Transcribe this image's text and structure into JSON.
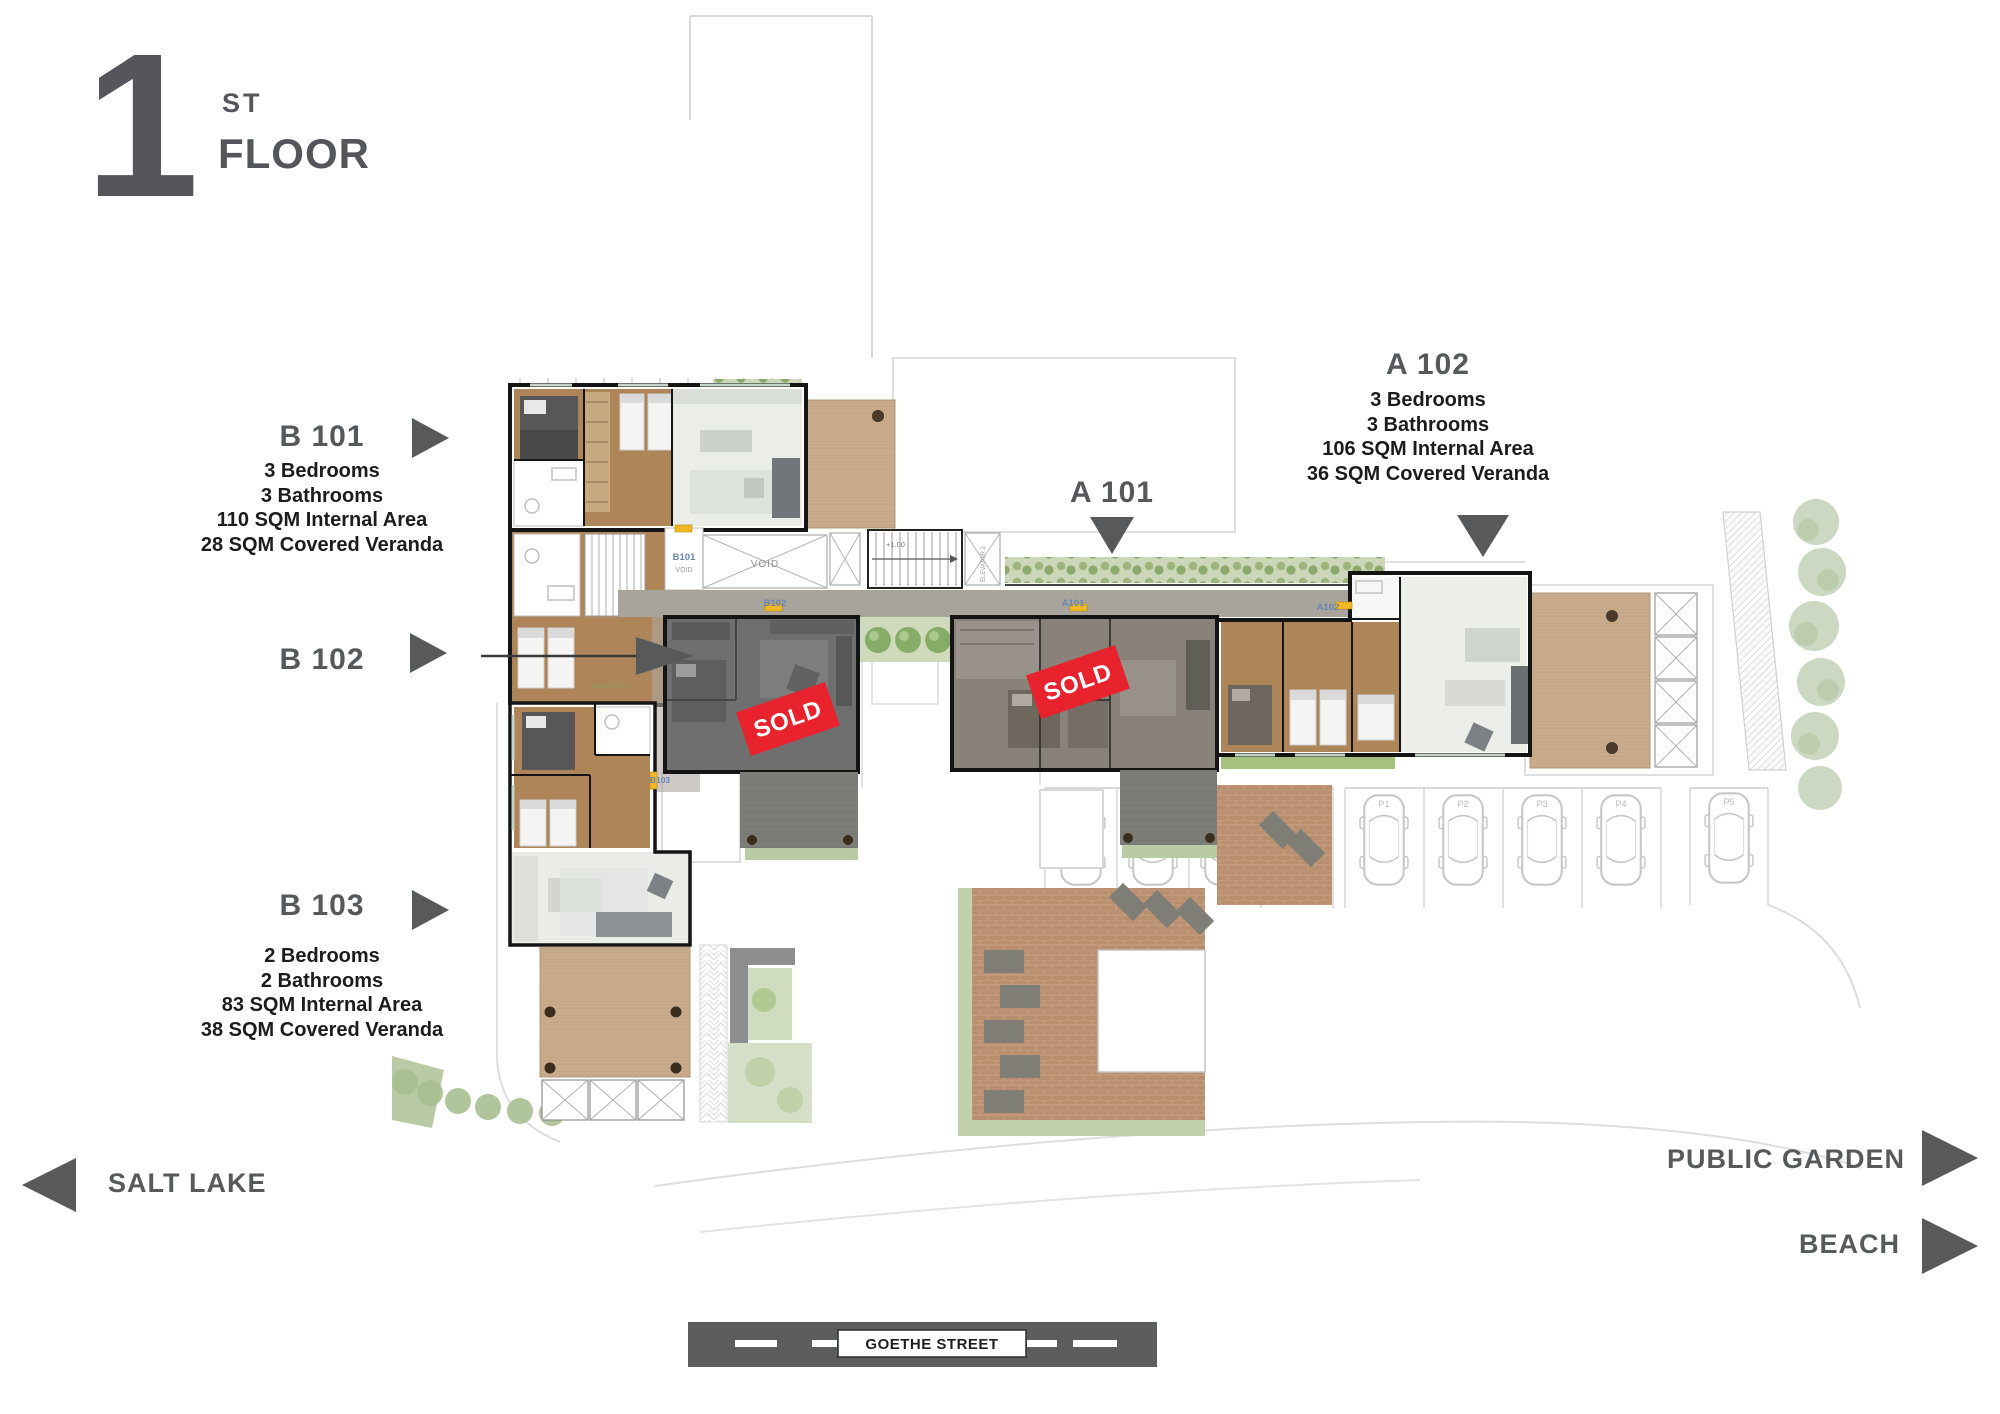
{
  "floor_header": {
    "number": "1",
    "ordinal": "ST",
    "word": "FLOOR"
  },
  "callouts": {
    "b101": {
      "title": "B 101",
      "details": [
        "3 Bedrooms",
        "3 Bathrooms",
        "110 SQM Internal Area",
        "28 SQM Covered Veranda"
      ]
    },
    "b102": {
      "title": "B 102"
    },
    "b103": {
      "title": "B 103",
      "details": [
        "2 Bedrooms",
        "2 Bathrooms",
        "83 SQM Internal Area",
        "38 SQM Covered Veranda"
      ]
    },
    "a101": {
      "title": "A 101"
    },
    "a102": {
      "title": "A 102",
      "details": [
        "3 Bedrooms",
        "3 Bathrooms",
        "106 SQM Internal Area",
        "36 SQM Covered Veranda"
      ]
    }
  },
  "sold_badge": {
    "label": "SOLD",
    "color": "#e8232e"
  },
  "directions": {
    "salt_lake": "SALT LAKE",
    "public_garden": "PUBLIC GARDEN",
    "beach": "BEACH"
  },
  "street": {
    "name": "GOETHE STREET"
  },
  "plan_texts": {
    "void": "VOID",
    "elevator_1": "ELEVATOR 1",
    "elevator_2": "ELEVATOR 2",
    "stairs_level": "+1.00",
    "corridor_b101": "B101",
    "corridor_b102": "B102",
    "corridor_a101": "A101",
    "corridor_a102": "A102",
    "corridor_b103": "B103",
    "parking_labels": [
      "P1",
      "P2",
      "P3",
      "P4",
      "P5"
    ]
  },
  "colors": {
    "label_gray": "#58595b",
    "detail_text": "#1c1c1c",
    "sold_red": "#e8232e",
    "wood_brown": "#ae8459",
    "deck_tan": "#c9ab8c",
    "brick_courtyard": "#b8906f",
    "sold_unit_gray": "#6f6f6f",
    "corridor_gray": "#a8a39b",
    "hedge_green": "#8fae72",
    "road_bar_gray": "#5c5d5f",
    "corridor_label_blue": "#6787b2",
    "door_marker_yellow": "#f2b824"
  }
}
